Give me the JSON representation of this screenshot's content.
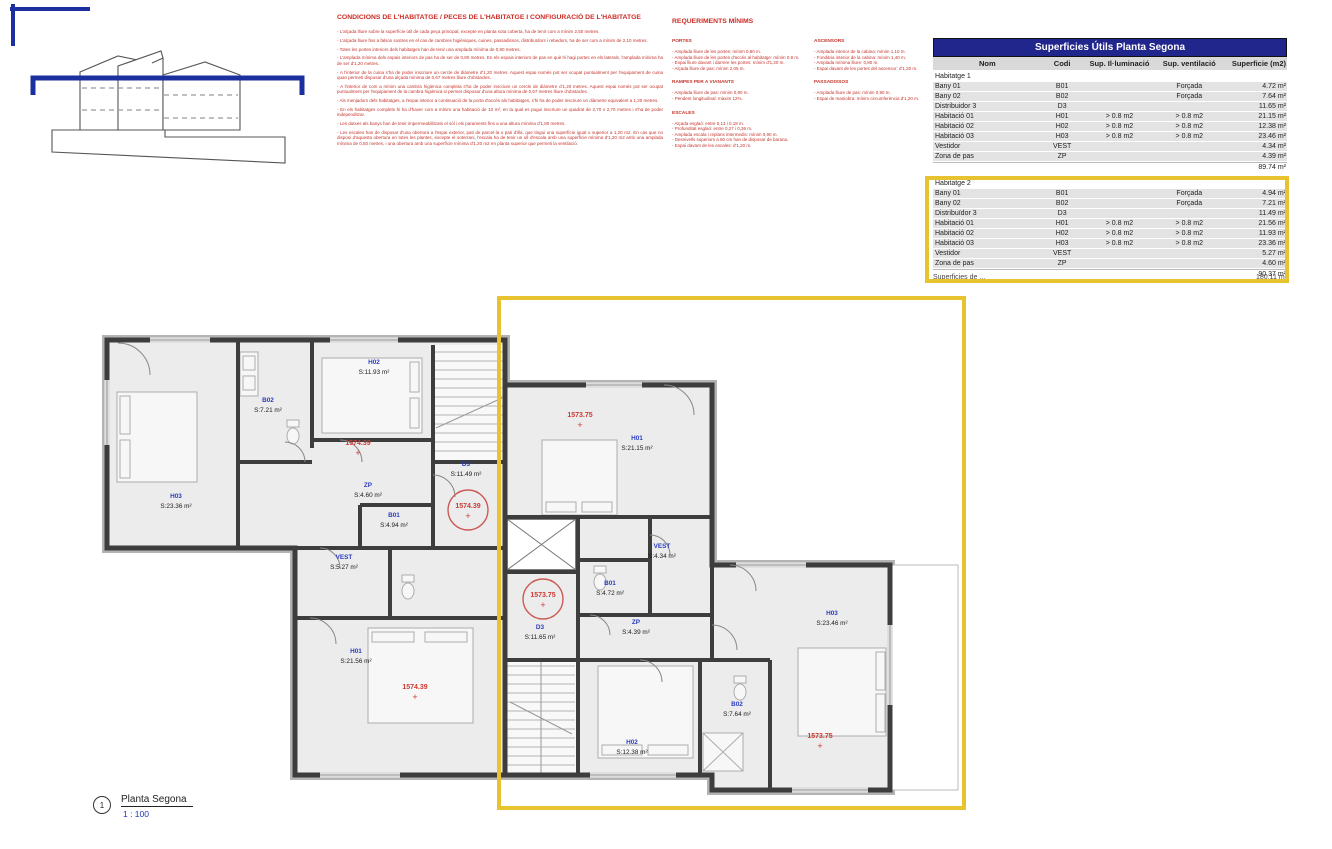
{
  "colors": {
    "accent_yellow": "#e7c42f",
    "table_header_blue": "#21268d",
    "room_label_blue": "#2b3cc0",
    "datum_red": "#cc3a33",
    "normative_text_red": "#c5342c"
  },
  "conditions": {
    "title": "CONDICIONS DE L'HABITATGE / PECES  DE L'HABITATGE I CONFIGURACIÓ DE L'HABITATGE",
    "bullets": [
      "- L'alçada lliure sobre la superfície útil de cada peça principal, excepte en planta sota coberta, ha de tenir com a mínim 2,50 metres.",
      "- L'alçada lliure fins a falsos sostres en el cas de cambres higièniques, cuines, passadissos, distribuïdors i rebedors, ha de ser com a mínim de 2,10 metres.",
      "- Totes les portes interiors dels habitatges han de tenir una amplada mínima de 0,80 metres.",
      "- L'amplada mínima dels espais interiors de pas ha de ser de 0,80 metres. En els espais interiors de pas en què hi hagi portes en els laterals, l'amplada mínima ha de ser d'1,20 metres.",
      "- A l'interior de la cuina s'ha de poder inscriure un cercle de diàmetre d'1,20 metres. Aquest espai només pot ser ocupat puntualment per l'equipament de cuina quan permeti disposar d'una alçada mínima de 0,67 metres lliure d'obstacles.",
      "- A l'interior de com a mínim una cambra higiènica completa s'ha de poder inscriure un cercle de diàmetre d'1,20 metres. Aquest espai només pot ser ocupat puntualment per l'equipament de la cambra higiènica si permet disposar d'una altura mínima de 0,67 metres lliure d'obstacles.",
      "- Als menjadors dels habitatges, a l'espai interior a continuació de la porta d'accés als habitatges, s'hi ha de poder inscriure un diàmetre equivalent a 1,20 metres.",
      "- En els habitatges complets hi ha d'haver com a mínim una habitació de 10 m², en la qual es pugui inscriure un quadrat de 2,70 x 2,70 metres i s'ha de poder independitzar.",
      "- Les dutxes als banys han de tenir impermeabilitzats el sòl i els paraments fins a una altura mínima d'1,80 metres.",
      "- Les escales han de disposar d'una obertura a l'espai exterior, pati de parcel·la o pati d'illa, que tingui una superfície igual o superior a 1,20 m2. En cas que no disposi d'aquesta obertura en totes les plantes, excepte el soterrani, l'escala ha de tenir un ull d'escala amb una superfície mínima d'1,20 m2 amb una amplada mínima de 0,50 metres, i una obertura amb una superfície mínima d'1,20 m2 en planta superior que permeti la ventilació."
    ]
  },
  "requirements": {
    "title": "REQUERIMENTS MÍNIMS",
    "sections": [
      {
        "title": "PORTES",
        "items": [
          "- Amplada lliure de les portes: mínim 0,80 m.",
          "- Amplada lliure de les portes d'accés al habitatge: mínim 0,9 m.",
          "- Espai lliure davant i darrere les portes: mínim d'1,20 m.",
          "- Alçada lliure de pas: mínim 2,05 m."
        ]
      },
      {
        "title": "RAMPES PER A VIANANTS",
        "items": [
          "- Amplada lliure de pas: mínim 0,90 m.",
          "- Pendent longitudinal: màxim 12%."
        ]
      },
      {
        "title": "ESCALES",
        "items": [
          "- Alçada esglaó: entre 0,13 i 0,18 m.",
          "- Profunditat esglaó: entre 0,27 i 0,36 m.",
          "- Amplada escala i replans intermedis: mínim 0,90 m.",
          "- Desnivells superiors a 60 cm han de disposar de barana.",
          "- Espai davant de les escales: d'1,20 m."
        ]
      },
      {
        "title": "ASCENSORS",
        "items": [
          "- Amplada interior de la cabina: mínim 1,10 m.",
          "- Fondària interior de la cabina: mínim 1,40 m.",
          "- Amplada mínima lliure: 0,80 m.",
          "- Espai davant de les portes del ascensor: d'1,20 m."
        ]
      },
      {
        "title": "PASSADISSOS",
        "items": [
          "- Amplada lliure de pas: mínim 0,90 m.",
          "- Espai de maniobra: mínim circumferència d'1,20 m."
        ]
      }
    ]
  },
  "table": {
    "title": "Superficies Útils Planta Segona",
    "columns": [
      "Nom",
      "Codi",
      "Sup. Il·luminació",
      "Sup. ventilació",
      "Superficie (m2)"
    ],
    "groups": [
      {
        "name": "Habitatge 1",
        "rows": [
          [
            "Bany 01",
            "B01",
            "",
            "Forçada",
            "4.72 m²"
          ],
          [
            "Bany 02",
            "B02",
            "",
            "Forçada",
            "7.64 m²"
          ],
          [
            "Distribuidor 3",
            "D3",
            "",
            "",
            "11.65 m²"
          ],
          [
            "Habitació 01",
            "H01",
            "> 0.8 m2",
            "> 0.8 m2",
            "21.15 m²"
          ],
          [
            "Habitació 02",
            "H02",
            "> 0.8 m2",
            "> 0.8 m2",
            "12.38 m²"
          ],
          [
            "Habitació 03",
            "H03",
            "> 0.8 m2",
            "> 0.8 m2",
            "23.46 m²"
          ],
          [
            "Vestidor",
            "VEST",
            "",
            "",
            "4.34 m²"
          ],
          [
            "Zona de pas",
            "ZP",
            "",
            "",
            "4.39 m²"
          ]
        ],
        "total": "89.74 m²"
      },
      {
        "name": "Habitatge 2",
        "rows": [
          [
            "Bany 01",
            "B01",
            "",
            "Forçada",
            "4.94 m²"
          ],
          [
            "Bany 02",
            "B02",
            "",
            "Forçada",
            "7.21 m²"
          ],
          [
            "Distribuïdor 3",
            "D3",
            "",
            "",
            "11.49 m²"
          ],
          [
            "Habitació 01",
            "H01",
            "> 0.8 m2",
            "> 0.8 m2",
            "21.56 m²"
          ],
          [
            "Habitació 02",
            "H02",
            "> 0.8 m2",
            "> 0.8 m2",
            "11.93 m²"
          ],
          [
            "Habitació 03",
            "H03",
            "> 0.8 m2",
            "> 0.8 m2",
            "23.36 m²"
          ],
          [
            "Vestidor",
            "VEST",
            "",
            "",
            "5.27 m²"
          ],
          [
            "Zona de pas",
            "ZP",
            "",
            "",
            "4.60 m²"
          ]
        ],
        "total": "90.37 m²"
      }
    ],
    "obscured": {
      "label": "Superficies de ...",
      "value": "180.11 m²"
    }
  },
  "plan": {
    "title": {
      "number": "1",
      "name": "Planta Segona",
      "scale": "1 : 100"
    },
    "rooms": [
      {
        "code": "H03",
        "area": "S:23.36 m²",
        "x": 176,
        "y": 498
      },
      {
        "code": "B02",
        "area": "S:7.21 m²",
        "x": 268,
        "y": 402
      },
      {
        "code": "H02",
        "area": "S:11.93 m²",
        "x": 374,
        "y": 364
      },
      {
        "code": "ZP",
        "area": "S:4.60 m²",
        "x": 368,
        "y": 487
      },
      {
        "code": "D3",
        "area": "S:11.49 m²",
        "x": 466,
        "y": 466
      },
      {
        "code": "B01",
        "area": "S:4.94 m²",
        "x": 394,
        "y": 517
      },
      {
        "code": "VEST",
        "area": "S:5.27 m²",
        "x": 344,
        "y": 559
      },
      {
        "code": "H01",
        "area": "S:21.56 m²",
        "x": 356,
        "y": 653
      },
      {
        "code": "H01",
        "area": "S:21.15 m²",
        "x": 637,
        "y": 440
      },
      {
        "code": "VEST",
        "area": "S:4.34 m²",
        "x": 662,
        "y": 548
      },
      {
        "code": "B01",
        "area": "S:4.72 m²",
        "x": 610,
        "y": 585
      },
      {
        "code": "D3",
        "area": "S:11.65 m²",
        "x": 540,
        "y": 629
      },
      {
        "code": "ZP",
        "area": "S:4.39 m²",
        "x": 636,
        "y": 624
      },
      {
        "code": "H03",
        "area": "S:23.46 m²",
        "x": 832,
        "y": 615
      },
      {
        "code": "B02",
        "area": "S:7.64 m²",
        "x": 737,
        "y": 706
      },
      {
        "code": "H02",
        "area": "S:12.38 m²",
        "x": 632,
        "y": 744
      }
    ],
    "datums": [
      {
        "text": "1574.39",
        "x": 358,
        "y": 445,
        "circled": false
      },
      {
        "text": "1574.39",
        "x": 468,
        "y": 508,
        "circled": true
      },
      {
        "text": "1574.39",
        "x": 415,
        "y": 689,
        "circled": false
      },
      {
        "text": "1573.75",
        "x": 580,
        "y": 417,
        "circled": false
      },
      {
        "text": "1573.75",
        "x": 543,
        "y": 597,
        "circled": true
      },
      {
        "text": "1573.75",
        "x": 820,
        "y": 738,
        "circled": false
      }
    ]
  }
}
